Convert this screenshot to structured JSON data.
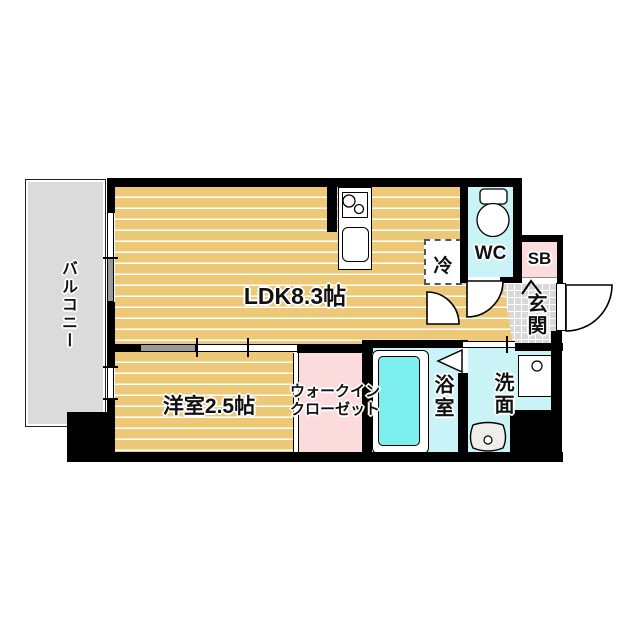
{
  "title": "apartment-floor-plan",
  "rooms": {
    "balcony": {
      "label": "バルコニー"
    },
    "ldk": {
      "label": "LDK8.3帖"
    },
    "western_room": {
      "label": "洋室2.5帖"
    },
    "walk_in_closet": {
      "label_line1": "ウォークイン",
      "label_line2": "クローゼット"
    },
    "bathroom": {
      "label": "浴室"
    },
    "washroom": {
      "label": "洗面"
    },
    "wc": {
      "label": "WC"
    },
    "genkan": {
      "label": "玄関"
    },
    "shoe_box": {
      "label": "SB"
    },
    "refrigerator": {
      "label": "冷"
    }
  },
  "colors": {
    "floor_tan": "#edc977",
    "room_cyan": "#c9f3f6",
    "bathtub_cyan": "#7deeee",
    "closet_pink": "#fbdbdb",
    "tile_gray": "#d8d8d8",
    "balcony_gray": "#dbdbdb",
    "wall_black": "#000000"
  }
}
